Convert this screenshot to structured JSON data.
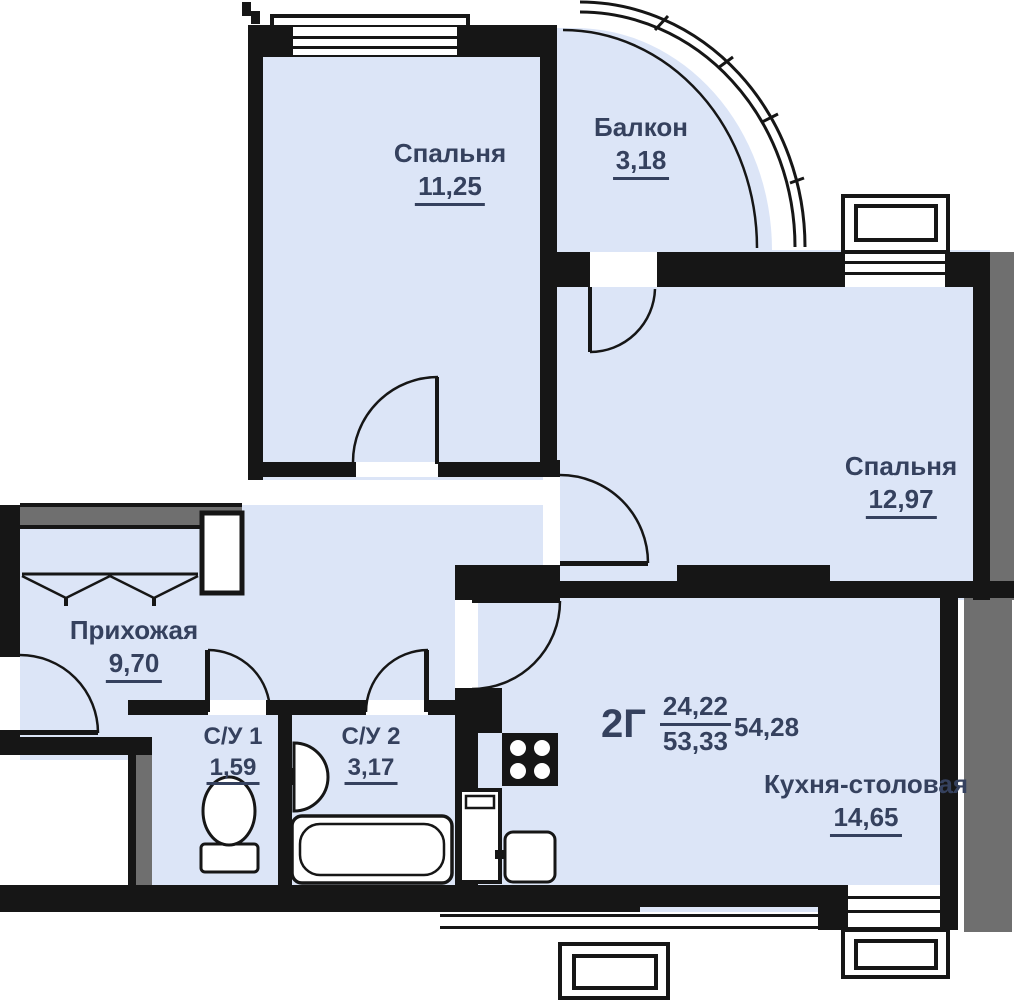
{
  "plan": {
    "unit": {
      "type_label": "2Г",
      "living_area": "24,22",
      "apartment_area": "53,33",
      "total_area": "54,28"
    },
    "rooms": [
      {
        "id": "bedroom-1",
        "name": "Спальня",
        "area": "11,25"
      },
      {
        "id": "balcony",
        "name": "Балкон",
        "area": "3,18"
      },
      {
        "id": "bedroom-2",
        "name": "Спальня",
        "area": "12,97"
      },
      {
        "id": "hallway",
        "name": "Прихожая",
        "area": "9,70"
      },
      {
        "id": "bathroom-1",
        "name": "С/У 1",
        "area": "1,59"
      },
      {
        "id": "bathroom-2",
        "name": "С/У 2",
        "area": "3,17"
      },
      {
        "id": "kitchen",
        "name": "Кухня-столовая",
        "area": "14,65"
      }
    ],
    "colors": {
      "room_fill": "#dce5f7",
      "wall": "#161616",
      "wall_secondary": "#6f6f6f",
      "label_text": "#35415e"
    }
  }
}
